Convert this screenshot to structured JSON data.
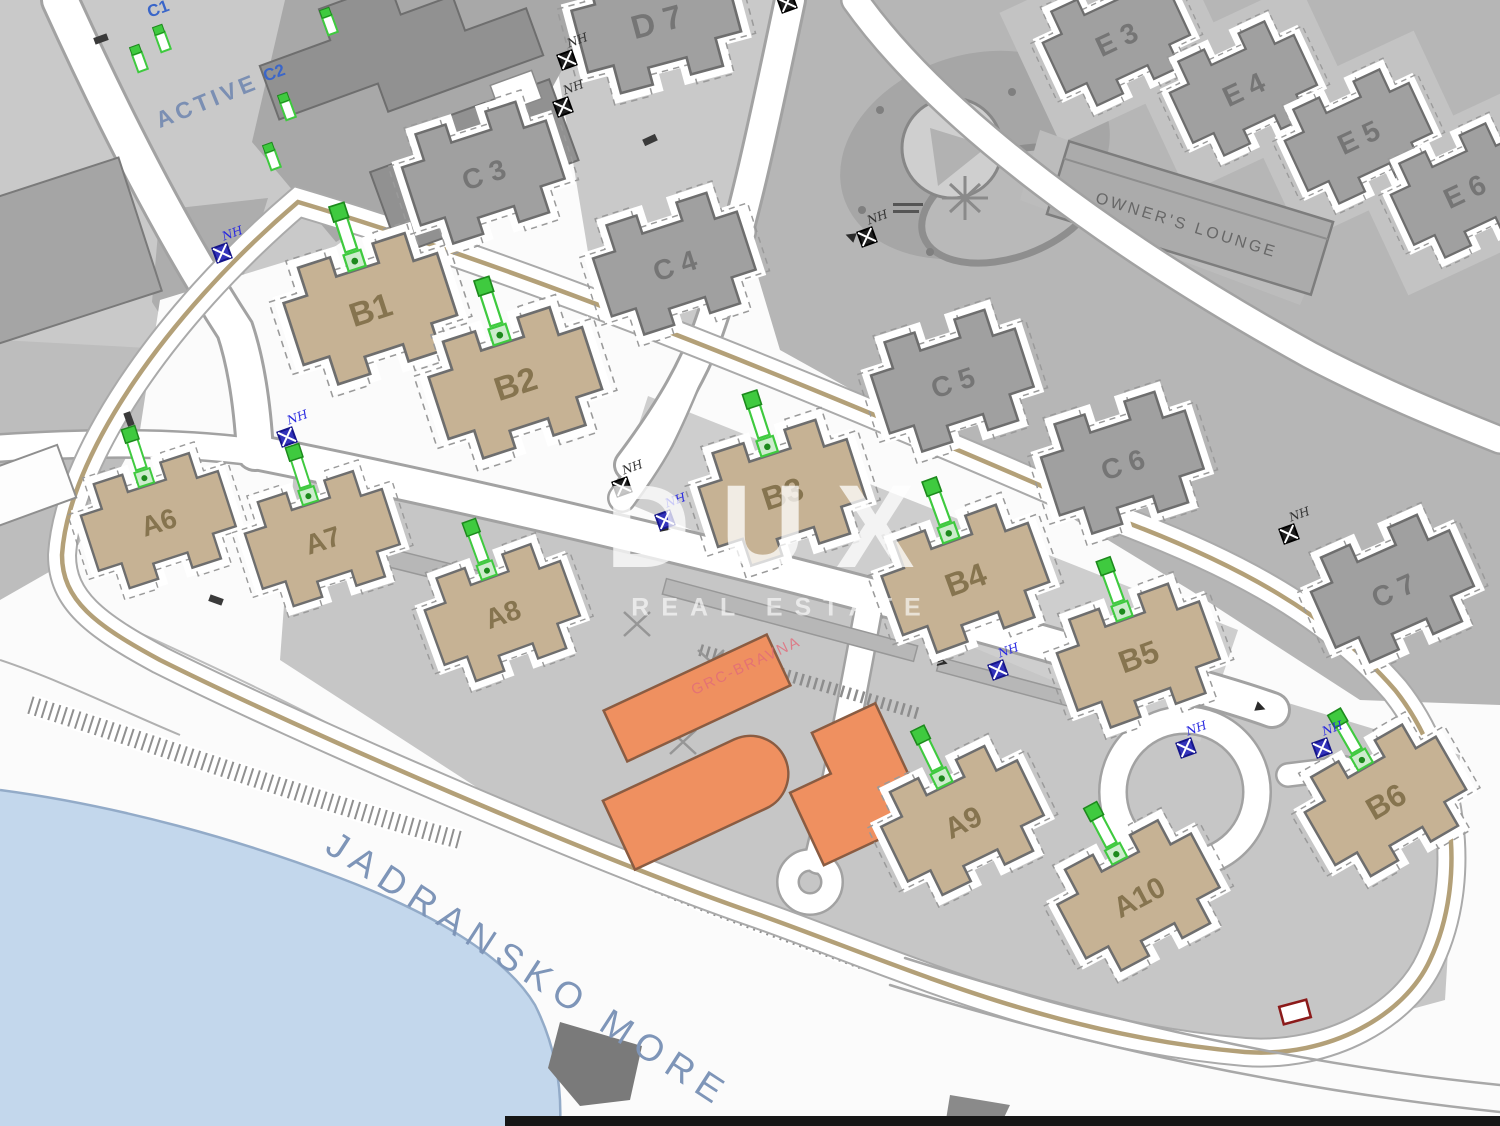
{
  "watermark": {
    "line1": "DUX",
    "line2": "REAL ESTATE"
  },
  "buildings": [
    {
      "label": "B1",
      "type": "tan",
      "x": 370,
      "y": 308,
      "rot": -18,
      "s": 1.12,
      "fs": 30
    },
    {
      "label": "B2",
      "type": "tan",
      "x": 515,
      "y": 382,
      "rot": -18,
      "s": 1.12,
      "fs": 30
    },
    {
      "label": "B3",
      "type": "tan",
      "x": 782,
      "y": 492,
      "rot": -18,
      "s": 1.08,
      "fs": 30
    },
    {
      "label": "B4",
      "type": "tan",
      "x": 965,
      "y": 578,
      "rot": -20,
      "s": 1.08,
      "fs": 30
    },
    {
      "label": "B5",
      "type": "tan",
      "x": 1138,
      "y": 655,
      "rot": -20,
      "s": 1.05,
      "fs": 30
    },
    {
      "label": "B6",
      "type": "tan",
      "x": 1385,
      "y": 800,
      "rot": -30,
      "s": 1.05,
      "fs": 30
    },
    {
      "label": "A6",
      "type": "tan",
      "x": 158,
      "y": 520,
      "rot": -18,
      "s": 1.0,
      "fs": 28
    },
    {
      "label": "A7",
      "type": "tan",
      "x": 322,
      "y": 538,
      "rot": -18,
      "s": 1.0,
      "fs": 28
    },
    {
      "label": "A8",
      "type": "tan",
      "x": 502,
      "y": 612,
      "rot": -20,
      "s": 1.0,
      "fs": 28
    },
    {
      "label": "A9",
      "type": "tan",
      "x": 962,
      "y": 820,
      "rot": -26,
      "s": 1.05,
      "fs": 28
    },
    {
      "label": "A10",
      "type": "tan",
      "x": 1138,
      "y": 895,
      "rot": -28,
      "s": 1.05,
      "fs": 28
    },
    {
      "label": "C 3",
      "type": "gray",
      "x": 483,
      "y": 172,
      "rot": -18,
      "s": 1.05,
      "fs": 27
    },
    {
      "label": "C 4",
      "type": "gray",
      "x": 674,
      "y": 263,
      "rot": -18,
      "s": 1.05,
      "fs": 27
    },
    {
      "label": "C 5",
      "type": "gray",
      "x": 952,
      "y": 380,
      "rot": -18,
      "s": 1.05,
      "fs": 27
    },
    {
      "label": "C 6",
      "type": "gray",
      "x": 1122,
      "y": 462,
      "rot": -18,
      "s": 1.05,
      "fs": 27
    },
    {
      "label": "C 7",
      "type": "gray",
      "x": 1392,
      "y": 588,
      "rot": -24,
      "s": 1.05,
      "fs": 27
    },
    {
      "label": "D 7",
      "type": "gray",
      "x": 656,
      "y": 20,
      "rot": -15,
      "s": 1.1,
      "fs": 30
    },
    {
      "label": "E 3",
      "type": "gray",
      "x": 1116,
      "y": 38,
      "rot": -25,
      "s": 0.95,
      "fs": 30
    },
    {
      "label": "E 4",
      "type": "gray",
      "x": 1243,
      "y": 88,
      "rot": -25,
      "s": 0.95,
      "fs": 30
    },
    {
      "label": "E 5",
      "type": "gray",
      "x": 1358,
      "y": 136,
      "rot": -25,
      "s": 0.95,
      "fs": 30
    },
    {
      "label": "E 6",
      "type": "gray",
      "x": 1464,
      "y": 190,
      "rot": -25,
      "s": 0.95,
      "fs": 30
    }
  ],
  "text_labels": [
    {
      "text": "C1",
      "x": 160,
      "y": 14,
      "rot": -20,
      "cls": "blue"
    },
    {
      "text": "C2",
      "x": 276,
      "y": 78,
      "rot": -20,
      "cls": "blue"
    },
    {
      "text": "ACTIVE",
      "x": 210,
      "y": 108,
      "rot": -22,
      "cls": "active"
    },
    {
      "text": "OWNER'S LOUNGE",
      "x": 1185,
      "y": 230,
      "rot": 17,
      "cls": "lounge"
    },
    {
      "text": "JADRANSKO MORE",
      "x": 522,
      "y": 980,
      "rot": 33,
      "cls": "sea"
    },
    {
      "text": "GRC-BRAVNA",
      "x": 748,
      "y": 670,
      "rot": -25,
      "cls": "red"
    }
  ],
  "markers": {
    "nh_label": "NH",
    "blue": [
      {
        "x": 222,
        "y": 253
      },
      {
        "x": 287,
        "y": 437
      },
      {
        "x": 665,
        "y": 520
      },
      {
        "x": 998,
        "y": 670
      },
      {
        "x": 1186,
        "y": 748
      },
      {
        "x": 1322,
        "y": 748
      }
    ],
    "black": [
      {
        "x": 567,
        "y": 60
      },
      {
        "x": 563,
        "y": 107
      },
      {
        "x": 787,
        "y": 3
      },
      {
        "x": 867,
        "y": 237
      },
      {
        "x": 622,
        "y": 487
      },
      {
        "x": 1289,
        "y": 534
      }
    ],
    "green": [
      {
        "x": 163,
        "y": 42
      },
      {
        "x": 140,
        "y": 62
      },
      {
        "x": 288,
        "y": 110
      },
      {
        "x": 273,
        "y": 160
      },
      {
        "x": 330,
        "y": 25
      }
    ],
    "red_rect": {
      "x": 1295,
      "y": 1012,
      "rot": -15
    }
  },
  "colors": {
    "sea": "#c3d7ec",
    "coast": "#93abc8",
    "terrain_light": "#c9c9c9",
    "terrain_mid": "#b6b6b6",
    "pad": "#c6c6c6",
    "band": "#cecece",
    "e_pad": "#c3c3c3",
    "building_gray": "#a0a0a0",
    "building_dark": "#919191",
    "stroke_gray": "#6e6e6e",
    "unit_tan": "#c6b294",
    "unit_label": "#86744f",
    "orange": "#ef9060",
    "orange_stroke": "#8a5c42",
    "boundary_tan": "#b3a078",
    "road_casing": "#a2a2a2",
    "marker_green": "#3fca3f",
    "marker_green_dark": "#1d8a1d",
    "marker_blue": "#3333bb",
    "marker_black": "#1e1e1e",
    "label_blue": "#3a66c9",
    "active_label": "#7b8fb3",
    "sea_label": "#7e95b8",
    "gray_label": "#757575",
    "red_annotation": "#e26b7a",
    "watermark": "#ffffff"
  }
}
